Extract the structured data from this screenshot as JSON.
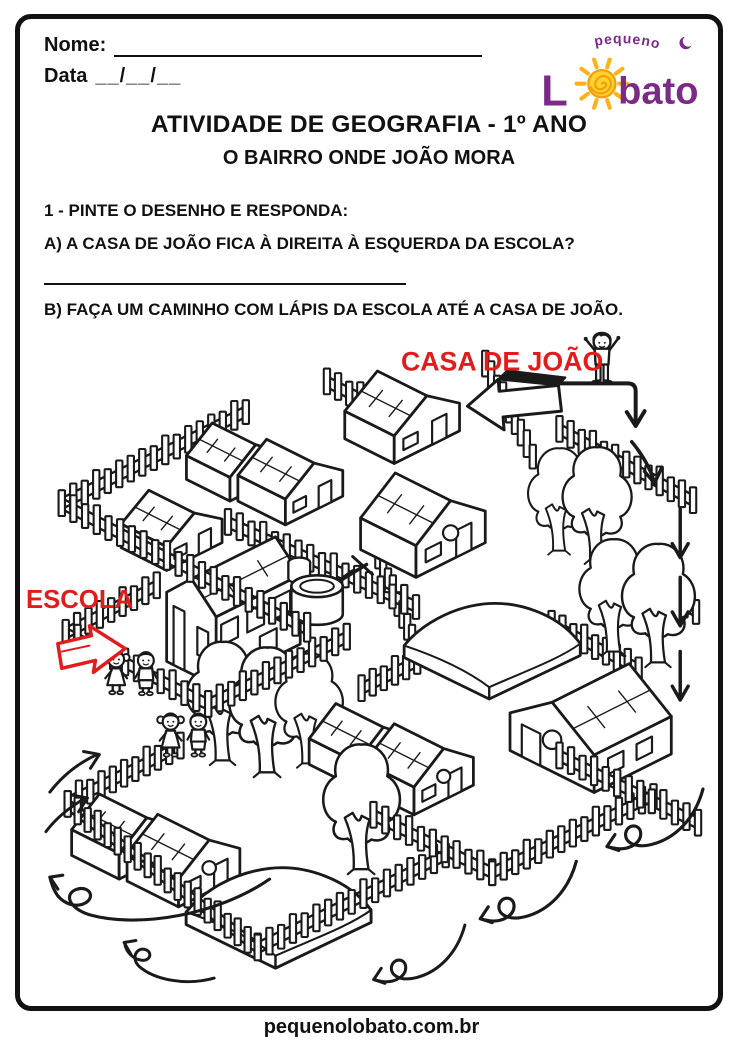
{
  "header": {
    "name_label": "Nome:",
    "date_label": "Data",
    "date_value": "__/__/__"
  },
  "logo": {
    "word_top": "pequeno",
    "letter_l": "L",
    "word_rest": "bato",
    "purple": "#7b2a86",
    "yellow": "#ffd32e",
    "orange": "#f59e0b"
  },
  "title": "ATIVIDADE DE GEOGRAFIA - 1º ANO",
  "subtitle": "O BAIRRO ONDE JOÃO MORA",
  "questions": {
    "q1": "1 - PINTE O DESENHO E RESPONDA:",
    "qa": "A) A CASA DE JOÃO FICA À DIREITA À ESQUERDA DA ESCOLA?",
    "qb": "B) FAÇA UM CAMINHO COM LÁPIS DA ESCOLA ATÉ A CASA DE JOÃO."
  },
  "illustration": {
    "casa_label": "CASA DE JOÃO",
    "escola_label": "ESCOLA",
    "label_color": "#e21b1b",
    "ink_color": "#1a1a1a"
  },
  "footer": "pequenolobato.com.br"
}
